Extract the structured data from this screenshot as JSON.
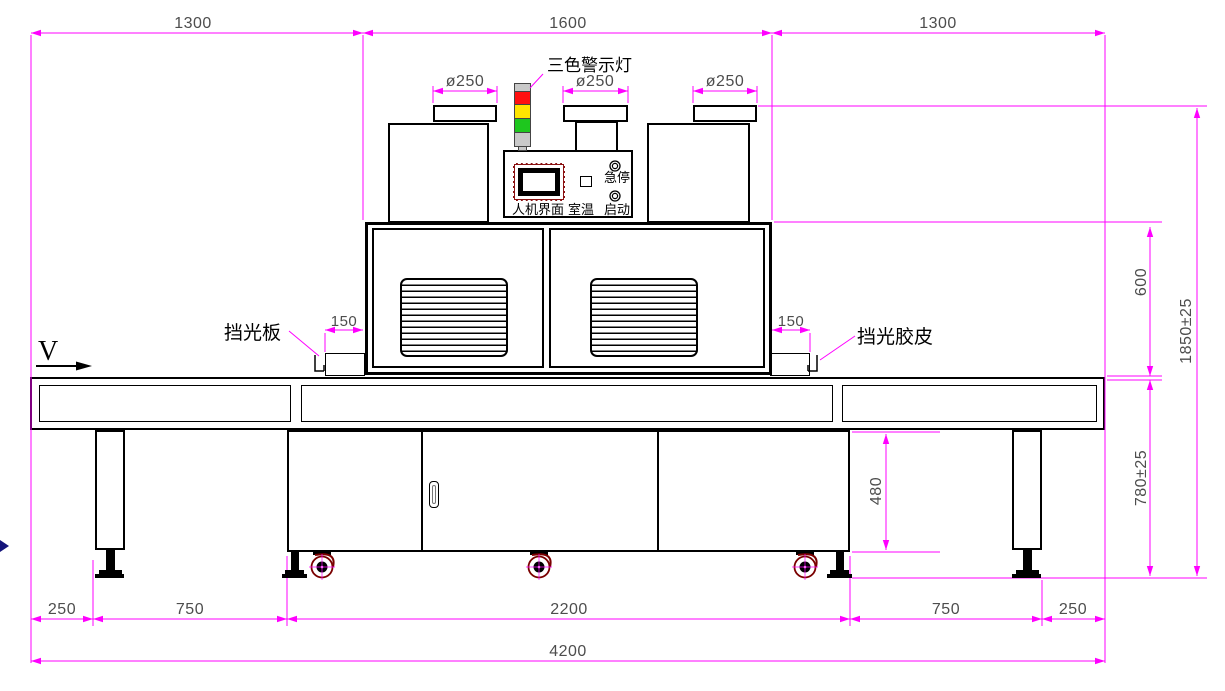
{
  "drawing": {
    "machine_labels": {
      "warning_light": "三色警示灯",
      "shade_plate": "挡光板",
      "shade_rubber": "挡光胶皮",
      "direction": "V"
    },
    "control_panel": {
      "hmi": "人机界面",
      "room_temp": "室温",
      "emergency_stop": "急停",
      "start": "启动"
    },
    "dimensions": {
      "top": [
        "1300",
        "1600",
        "1300"
      ],
      "cap_diameters": [
        "ø250",
        "ø250",
        "ø250"
      ],
      "shade_offsets": [
        "150",
        "150"
      ],
      "oven_height": "600",
      "overall_height": "1850±25",
      "table_height": "780±25",
      "cabinet_height": "480",
      "bottom": [
        "250",
        "750",
        "2200",
        "750",
        "250"
      ],
      "overall_length": "4200"
    },
    "colors": {
      "dimension_line": "#FF00FF",
      "dimension_text": "#4d4d4d",
      "outline": "#000000",
      "light_red": "#FF1010",
      "light_yellow": "#FFE500",
      "light_green": "#1EC71E",
      "light_gray": "#C9C9C9",
      "hmi_frame": "#8B1212",
      "caster_accent": "#7A0000"
    }
  }
}
